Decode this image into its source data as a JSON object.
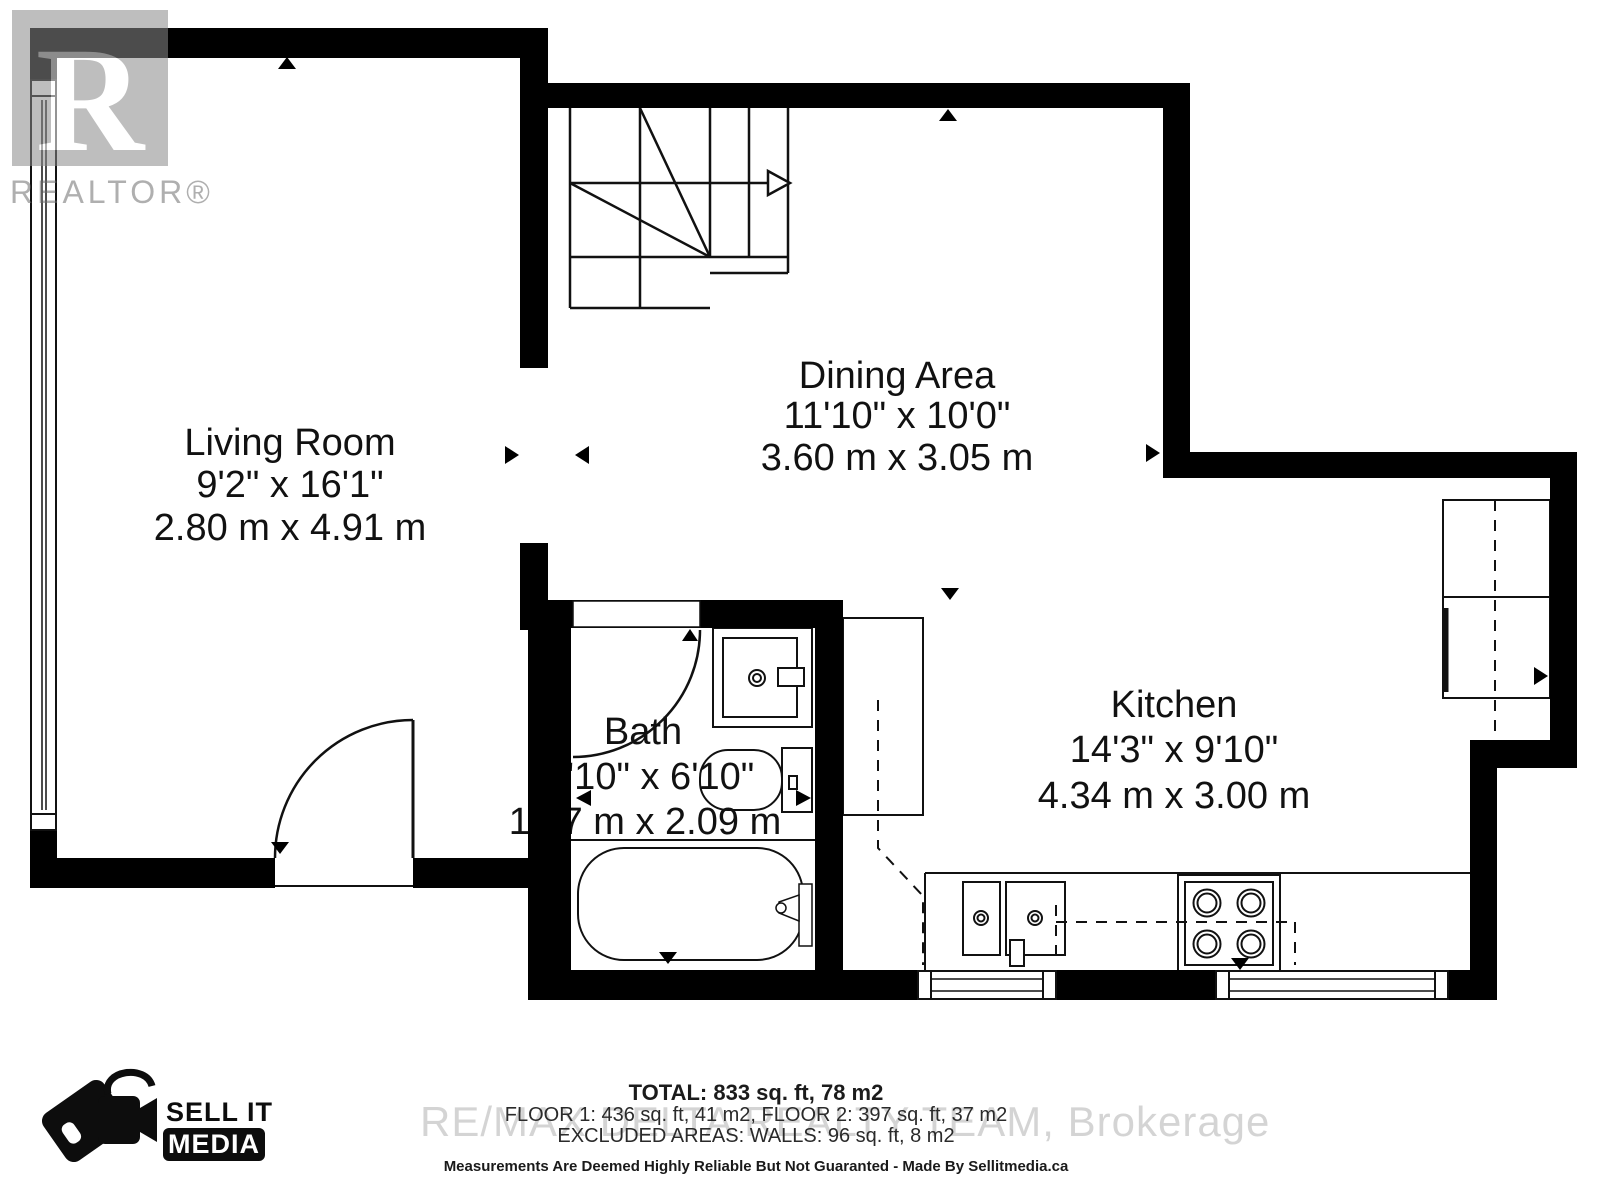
{
  "watermarks": {
    "realtor_letter": "R",
    "realtor_word": "REALTOR®",
    "brand": "RE/MAX DELTA REALTY TEAM, Brokerage"
  },
  "logo": {
    "line1": "SELL IT",
    "line2": "MEDIA"
  },
  "rooms": {
    "living": {
      "name": "Living Room",
      "imperial": "9'2\" x 16'1\"",
      "metric": "2.80 m x 4.91 m"
    },
    "dining": {
      "name": "Dining Area",
      "imperial": "11'10\" x 10'0\"",
      "metric": "3.60 m x 3.05 m"
    },
    "bath": {
      "name": "Bath",
      "imperial": "5'10\" x 6'10\"",
      "metric": "1.77 m x 2.09 m"
    },
    "kitchen": {
      "name": "Kitchen",
      "imperial": "14'3\" x 9'10\"",
      "metric": "4.34 m x 3.00 m"
    }
  },
  "footer": {
    "total": "TOTAL: 833 sq. ft, 78 m2",
    "floors": "FLOOR 1: 436 sq. ft, 41 m2, FLOOR 2: 397 sq. ft, 37 m2",
    "excluded": "EXCLUDED AREAS: WALLS: 96 sq. ft, 8 m2",
    "disclaimer": "Measurements Are Deemed Highly Reliable But Not Guaranted - Made By Sellitmedia.ca"
  },
  "colors": {
    "wall": "#000000",
    "line": "#111111",
    "watermark_gray": "#8a8a8a"
  }
}
